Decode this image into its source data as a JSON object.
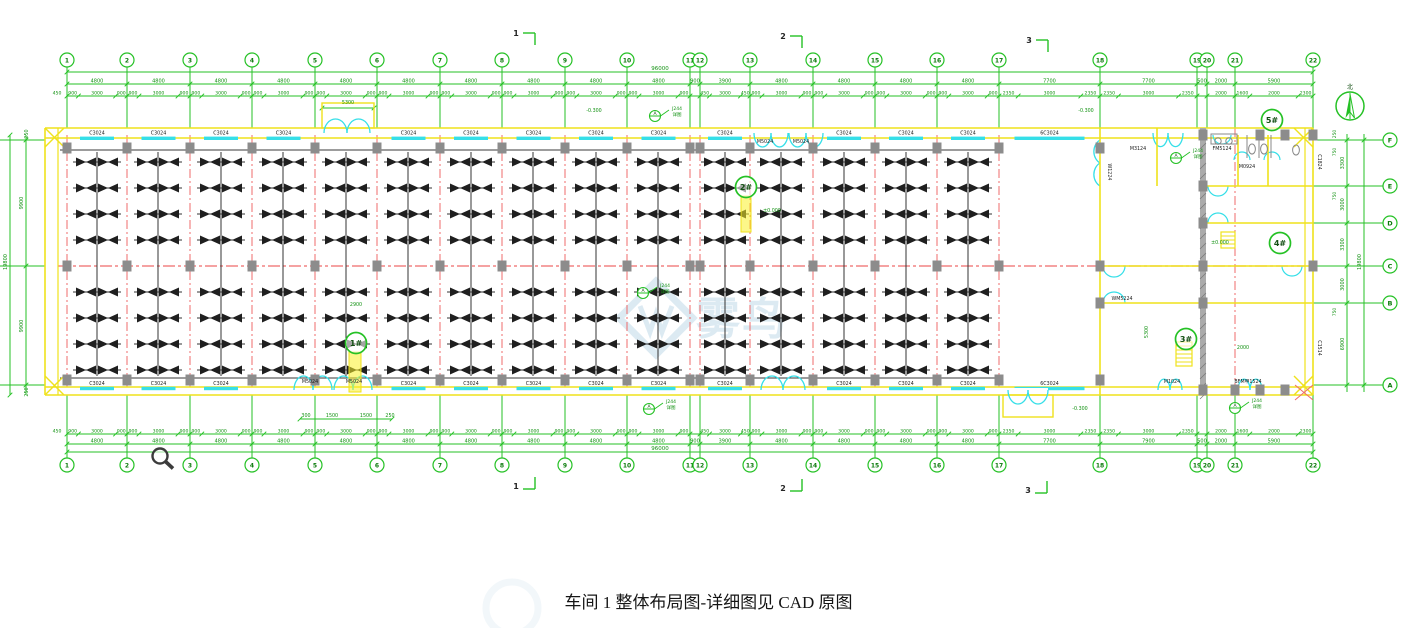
{
  "meta": {
    "caption": "车间 1 整体布局图-详细图见 CAD 原图",
    "drawing_name": "车间1整体布局图"
  },
  "colors": {
    "grid_green": "#25c125",
    "dim_text_green": "#119111",
    "bubble_green": "#0b7a0b",
    "wall_yellow": "#efe21c",
    "window_cyan": "#35dfe8",
    "axis_red": "#ef6b6b",
    "column_gray": "#8c8c8c",
    "machine_black": "#1f1f1f",
    "gray_wall": "#ababab",
    "watermark_blue": "#9cc3dc",
    "black_text": "#1c1c1c"
  },
  "axes": {
    "top_labels": [
      "1",
      "2",
      "3",
      "4",
      "5",
      "6",
      "7",
      "8",
      "9",
      "10",
      "11",
      "12",
      "13",
      "14",
      "15",
      "16",
      "17",
      "18",
      "19",
      "20",
      "21",
      "22"
    ],
    "xs": [
      67,
      127,
      190,
      252,
      315,
      377,
      440,
      502,
      565,
      627,
      690,
      700,
      750,
      813,
      875,
      937,
      999,
      1100,
      1197,
      1207,
      1235,
      1313
    ],
    "row_labels": [
      "F",
      "E",
      "D",
      "C",
      "B",
      "A"
    ],
    "row_ys": [
      140,
      186,
      223,
      266,
      303,
      385
    ],
    "bubble_x_right": 1390,
    "top_bubble_y": 60,
    "bottom_bubble_y": 465
  },
  "dims": {
    "total": "96000",
    "top_gaps": [
      "4800",
      "4800",
      "4800",
      "4800",
      "4800",
      "4800",
      "4800",
      "4800",
      "4800",
      "4800",
      "900",
      "3900",
      "4800",
      "4800",
      "4800",
      "4800",
      "7700",
      "7700",
      "500",
      "2000",
      "5900"
    ],
    "bottom_gaps": [
      "4800",
      "4800",
      "4800",
      "4800",
      "4800",
      "4800",
      "4800",
      "4800",
      "4800",
      "4800",
      "900",
      "3900",
      "4800",
      "4800",
      "4800",
      "4800",
      "7700",
      "7900",
      "500",
      "2000",
      "5900"
    ],
    "sub_default": [
      "900",
      "3000",
      "900"
    ],
    "sub_overrides": {
      "11": [
        "450",
        "3000",
        "450"
      ],
      "16": [
        "2350",
        "3000",
        "2350"
      ],
      "17": [
        "2350",
        "3000",
        "2350"
      ],
      "20": [
        "1600",
        "2000",
        "2300"
      ]
    },
    "edge_left": "450",
    "left": {
      "total": "19800",
      "segments": [
        "9900",
        "9900"
      ]
    },
    "right": {
      "total": "19800",
      "segments": [
        "3300",
        "3000",
        "3300",
        "3000",
        "6900"
      ],
      "small": [
        {
          "t": "250",
          "y": 134
        },
        {
          "t": "750",
          "y": 152
        },
        {
          "t": "750",
          "y": 196
        },
        {
          "t": "750",
          "y": 312
        }
      ]
    },
    "aux_lines": [
      [
        322,
        108,
        374,
        108
      ],
      [
        300,
        419,
        392,
        419
      ]
    ]
  },
  "sections": {
    "top": [
      {
        "t": "1",
        "x": 516,
        "y": 36
      },
      {
        "t": "2",
        "x": 783,
        "y": 39
      },
      {
        "t": "3",
        "x": 1029,
        "y": 43
      }
    ],
    "bottom": [
      {
        "t": "1",
        "x": 516,
        "y": 489
      },
      {
        "t": "2",
        "x": 783,
        "y": 491
      },
      {
        "t": "3",
        "x": 1028,
        "y": 493
      }
    ]
  },
  "building": {
    "x1": 45,
    "x2": 1313,
    "y1": 128,
    "y1b": 138,
    "y2a": 387,
    "y2": 395,
    "window_label": "C3024",
    "wide_window_label": "6C3024",
    "top_window_gaps": [
      0,
      1,
      2,
      3,
      5,
      6,
      7,
      8,
      9,
      11,
      13,
      14,
      15
    ],
    "bottom_window_gaps": [
      0,
      1,
      2,
      5,
      6,
      7,
      8,
      9,
      11,
      13,
      14,
      15
    ],
    "wide_window_gap": 16,
    "mid_row_y": 266,
    "rail_rows": [
      150,
      378
    ]
  },
  "machines": {
    "strip_xs": [
      97,
      158,
      221,
      283,
      346,
      408,
      471,
      533,
      596,
      658,
      725,
      781,
      844,
      906,
      968
    ],
    "rows_upper": [
      162,
      188,
      214,
      240
    ],
    "rows_lower": [
      292,
      318,
      344,
      370
    ]
  },
  "doors": {
    "top": [
      {
        "x": 347,
        "w": 46,
        "vest": true
      },
      {
        "x": 771,
        "w": 34
      },
      {
        "x": 806,
        "w": 34
      },
      {
        "x": 1168,
        "w": 30
      }
    ],
    "bottom": [
      {
        "x": 313,
        "w": 38
      },
      {
        "x": 353,
        "w": 38
      },
      {
        "x": 783,
        "w": 44
      },
      {
        "x": 1028,
        "w": 40,
        "vest": true
      },
      {
        "x": 1170,
        "w": 24
      },
      {
        "x": 1250,
        "w": 24
      }
    ],
    "left_wall_door": {
      "x": 1100,
      "y": 163,
      "w": 46
    },
    "interior": [
      {
        "x": 1114,
        "y": 266,
        "r": 11,
        "up": false
      },
      {
        "x": 1114,
        "y": 303,
        "r": 11,
        "up": true
      },
      {
        "x": 1218,
        "y": 186,
        "r": 10,
        "up": false
      },
      {
        "x": 1218,
        "y": 223,
        "r": 10,
        "up": true
      },
      {
        "x": 1292,
        "y": 266,
        "r": 10,
        "up": false
      },
      {
        "x": 1242,
        "y": 160,
        "r": 8,
        "up": true
      },
      {
        "x": 1272,
        "y": 160,
        "r": 8,
        "up": true
      },
      {
        "x": 1222,
        "y": 135,
        "r": 9,
        "up": false
      }
    ],
    "vest_top": {
      "x": 322,
      "y": 103,
      "w": 52,
      "h": 25
    },
    "vest_bottom": {
      "x": 1003,
      "y": 395,
      "w": 50,
      "h": 22
    }
  },
  "office": {
    "walls": [
      [
        1100,
        128,
        1100,
        395
      ],
      [
        1157,
        128,
        1157,
        186
      ],
      [
        1238,
        135,
        1238,
        186
      ],
      [
        1268,
        135,
        1268,
        186
      ],
      [
        1203,
        186,
        1313,
        186
      ],
      [
        1203,
        223,
        1313,
        223
      ],
      [
        1100,
        266,
        1313,
        266
      ],
      [
        1100,
        303,
        1313,
        303
      ]
    ],
    "gray_wall": {
      "x": 1200,
      "y": 128,
      "w": 6,
      "h": 267
    },
    "red_rows": [
      [
        1203,
        186,
        1305,
        186
      ],
      [
        1203,
        223,
        1305,
        223
      ],
      [
        1100,
        303,
        1305,
        303
      ]
    ],
    "red_cols": [
      1235
    ],
    "stairs": [
      {
        "x": 1176,
        "y": 342,
        "w": 16,
        "h": 24,
        "n": 6
      },
      {
        "x": 1221,
        "y": 232,
        "w": 14,
        "h": 16,
        "n": 4
      }
    ],
    "toilet": {
      "partitions": [
        [
          1247,
          135,
          1247,
          158
        ],
        [
          1259,
          135,
          1259,
          158
        ],
        [
          1271,
          135,
          1271,
          158
        ]
      ],
      "counter": [
        1211,
        134,
        26,
        10
      ],
      "sinks": [
        [
          1218,
          141
        ],
        [
          1229,
          141
        ]
      ],
      "wcs": [
        [
          1252,
          149
        ],
        [
          1264,
          149
        ],
        [
          1296,
          150
        ]
      ]
    }
  },
  "columns": {
    "rows": [
      148,
      266,
      380
    ],
    "main_axis_count": 17,
    "extra": [
      [
        1100,
        148
      ],
      [
        1100,
        266
      ],
      [
        1100,
        303
      ],
      [
        1100,
        380
      ],
      [
        1203,
        135
      ],
      [
        1203,
        186
      ],
      [
        1203,
        223
      ],
      [
        1203,
        266
      ],
      [
        1203,
        303
      ],
      [
        1203,
        390
      ],
      [
        1260,
        135
      ],
      [
        1260,
        390
      ],
      [
        1285,
        135
      ],
      [
        1313,
        135
      ],
      [
        1313,
        266
      ],
      [
        1235,
        390
      ],
      [
        1285,
        390
      ]
    ]
  },
  "labels": [
    {
      "t": "M5024",
      "x": 765,
      "y": 143
    },
    {
      "t": "M5024",
      "x": 801,
      "y": 143
    },
    {
      "t": "M5024",
      "x": 310,
      "y": 383
    },
    {
      "t": "M5024",
      "x": 354,
      "y": 383
    },
    {
      "t": "M1024",
      "x": 1172,
      "y": 383
    },
    {
      "t": "BFM甲1524",
      "x": 1248,
      "y": 383
    },
    {
      "t": "M3124",
      "x": 1138,
      "y": 150
    },
    {
      "t": "FM5124",
      "x": 1222,
      "y": 150
    },
    {
      "t": "M0924",
      "x": 1247,
      "y": 168
    },
    {
      "t": "WM5224",
      "x": 1122,
      "y": 300
    },
    {
      "t": "C1824",
      "x": 1318,
      "y": 162,
      "rot": 90
    },
    {
      "t": "C1514",
      "x": 1318,
      "y": 348,
      "rot": 90
    },
    {
      "t": "W1224",
      "x": 1108,
      "y": 172,
      "rot": 90
    }
  ],
  "green_texts": [
    {
      "t": "-0.300",
      "x": 594,
      "y": 112
    },
    {
      "t": "-0.300",
      "x": 1086,
      "y": 112
    },
    {
      "t": "-0.300",
      "x": 1080,
      "y": 410
    },
    {
      "t": "±0.000",
      "x": 772,
      "y": 212
    },
    {
      "t": "±0.000",
      "x": 1220,
      "y": 244
    },
    {
      "t": "5300",
      "x": 348,
      "y": 104
    },
    {
      "t": "2900",
      "x": 356,
      "y": 306
    },
    {
      "t": "300",
      "x": 306,
      "y": 417
    },
    {
      "t": "1500",
      "x": 332,
      "y": 417
    },
    {
      "t": "1500",
      "x": 366,
      "y": 417
    },
    {
      "t": "250",
      "x": 390,
      "y": 417
    },
    {
      "t": "5300",
      "x": 1148,
      "y": 332,
      "rot": -90
    },
    {
      "t": "2000",
      "x": 1243,
      "y": 349
    },
    {
      "t": "250",
      "x": 28,
      "y": 134,
      "rot": -90
    },
    {
      "t": "250",
      "x": 28,
      "y": 392,
      "rot": -90
    }
  ],
  "markers": [
    {
      "t": "1#",
      "x": 356,
      "y": 343
    },
    {
      "t": "2#",
      "x": 746,
      "y": 187
    },
    {
      "t": "3#",
      "x": 1186,
      "y": 339
    },
    {
      "t": "4#",
      "x": 1280,
      "y": 243
    },
    {
      "t": "5#",
      "x": 1272,
      "y": 120
    }
  ],
  "highlights": [
    [
      349,
      352,
      12,
      40
    ],
    [
      741,
      196,
      10,
      36
    ]
  ],
  "callouts": {
    "letter": "A",
    "note1": "J244",
    "note2": "详图",
    "points": [
      {
        "x": 655,
        "y": 116
      },
      {
        "x": 643,
        "y": 293
      },
      {
        "x": 649,
        "y": 409
      },
      {
        "x": 1176,
        "y": 158
      },
      {
        "x": 1235,
        "y": 408
      }
    ]
  },
  "north": {
    "x": 1350,
    "y": 106,
    "r": 14,
    "label": "北"
  },
  "cursor": {
    "x": 160,
    "y": 456
  },
  "watermark": {
    "x": 656,
    "y": 318,
    "chars": [
      "雾",
      "鸟"
    ],
    "logo": "W"
  }
}
